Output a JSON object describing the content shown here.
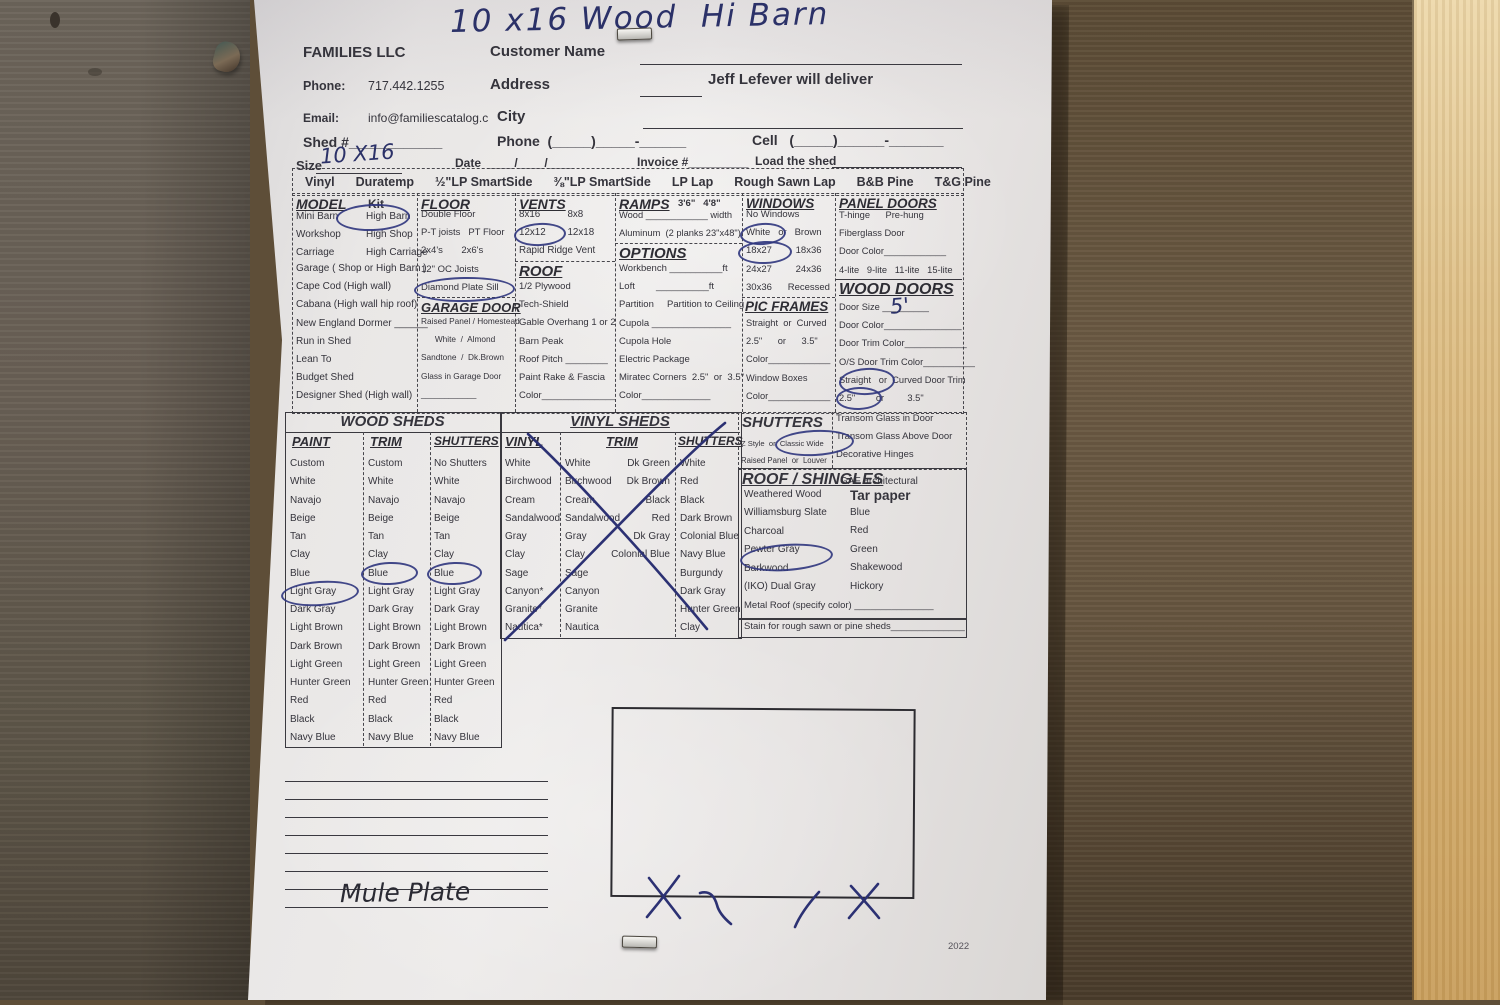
{
  "title_handwritten": "10 x16 Wood  Hi Barn",
  "header": {
    "company": "FAMILIES LLC",
    "customer_name_label": "Customer Name",
    "phone_label": "Phone:",
    "phone_value": "717.442.1255",
    "address_label": "Address",
    "deliver_note": "Jeff Lefever will deliver",
    "email_label": "Email:",
    "email_value": "info@familiescatalog.c",
    "city_label": "City",
    "shed_row": "Shed #____________",
    "phone_row": "Phone  (_____)_____-______",
    "cell_row": "Cell   (_____)______-_______",
    "size_label": "Size",
    "size_value_handwritten": "10 X16",
    "date_row": "Date  ____/____/____",
    "invoice_row": "Invoice #_________",
    "load_row": "Load the shed"
  },
  "siding_options": [
    "Vinyl",
    "Duratemp",
    "½\"LP SmartSide",
    "⅜\"LP SmartSide",
    "LP Lap",
    "Rough Sawn Lap",
    "B&B Pine",
    "T&G Pine"
  ],
  "model": {
    "header": "MODEL",
    "kit": "Kit",
    "pairs": [
      {
        "l": "Mini Barn",
        "r": "High Barn"
      },
      {
        "l": "Workshop",
        "r": "High Shop"
      },
      {
        "l": "Carriage",
        "r": "High Carriage"
      }
    ],
    "items": [
      "Garage ( Shop or High Barn )",
      "Cape Cod (High wall)",
      "Cabana (High wall hip roof)",
      "New England Dormer ______",
      "Run in Shed",
      "Lean To",
      "Budget Shed",
      "Designer Shed (High wall)"
    ]
  },
  "floor": {
    "header": "FLOOR",
    "items": [
      "Double Floor",
      "P-T joists   PT Floor",
      "2x4's       2x6's",
      "12\" OC Joists",
      "Diamond Plate Sill"
    ]
  },
  "garage_door": {
    "header": "GARAGE DOOR",
    "items": [
      "Raised Panel / Homestead",
      "      White  /  Almond",
      "Sandtone  /  Dk.Brown",
      "Glass in Garage Door",
      "____________"
    ]
  },
  "vents": {
    "header": "VENTS",
    "items": [
      "8x16          8x8",
      "12x12        12x18",
      "Rapid Ridge Vent"
    ]
  },
  "roof": {
    "header": "ROOF",
    "items": [
      "1/2 Plywood",
      "Tech-Shield",
      "Gable Overhang 1 or 2",
      "Barn Peak",
      "Roof Pitch ________",
      "Paint Rake & Fascia",
      "Color______________"
    ]
  },
  "ramps": {
    "header": "RAMPS",
    "sizes": "3'6\"   4'8\"",
    "items": [
      "Wood ____________ width",
      "Aluminum  (2 planks 23\"x48\")"
    ]
  },
  "options": {
    "header": "OPTIONS",
    "items": [
      "Workbench __________ft",
      "Loft        __________ft",
      "Partition     Partition to Ceiling",
      "Cupola _______________",
      "Cupola Hole",
      "Electric Package",
      "Miratec Corners  2.5\"  or  3.5\"",
      "Color_____________"
    ]
  },
  "windows": {
    "header": "WINDOWS",
    "items": [
      "No Windows",
      "White   or   Brown",
      "18x27         18x36",
      "24x27         24x36",
      "30x36      Recessed"
    ]
  },
  "pic_frames": {
    "header": "PIC FRAMES",
    "items": [
      "Straight  or  Curved",
      "2.5\"      or      3.5\"",
      "Color____________",
      "Window Boxes",
      "Color____________"
    ]
  },
  "panel_doors": {
    "header": "PANEL DOORS",
    "items": [
      "T-hinge      Pre-hung",
      "Fiberglass Door",
      "Door Color____________",
      "4-lite   9-lite   11-lite   15-lite"
    ]
  },
  "wood_doors": {
    "header": "WOOD DOORS",
    "size_value_handwritten": "5'",
    "items": [
      "Door Size _________",
      "Door Color_______________",
      "Door Trim Color____________",
      "O/S Door Trim Color__________",
      "Straight   or  Curved Door Trim",
      "2.5\"        or         3.5\""
    ]
  },
  "wood_sheds": {
    "title": "WOOD SHEDS",
    "col_headers": [
      "PAINT",
      "TRIM",
      "SHUTTERS"
    ],
    "paint": [
      "Custom",
      "White",
      "Navajo",
      "Beige",
      "Tan",
      "Clay",
      "Blue",
      "Light Gray",
      "Dark Gray",
      "Light Brown",
      "Dark Brown",
      "Light Green",
      "Hunter Green",
      "Red",
      "Black",
      "Navy Blue"
    ],
    "trim": [
      "Custom",
      "White",
      "Navajo",
      "Beige",
      "Tan",
      "Clay",
      "Blue",
      "Light Gray",
      "Dark Gray",
      "Light Brown",
      "Dark Brown",
      "Light Green",
      "Hunter Green",
      "Red",
      "Black",
      "Navy Blue"
    ],
    "shutters": [
      "No Shutters",
      "White",
      "Navajo",
      "Beige",
      "Tan",
      "Clay",
      "Blue",
      "Light Gray",
      "Dark Gray",
      "Light Brown",
      "Dark Brown",
      "Light Green",
      "Hunter Green",
      "Red",
      "Black",
      "Navy Blue"
    ]
  },
  "vinyl_sheds": {
    "title": "VINYL SHEDS",
    "col_headers": [
      "VINYL",
      "TRIM",
      "SHUTTERS"
    ],
    "vinyl": [
      "White",
      "Birchwood",
      "Cream",
      "Sandalwood",
      "Gray",
      "Clay",
      "Sage",
      "Canyon*",
      "Granite*",
      "Nautica*"
    ],
    "trim": [
      "White",
      "Birchwood",
      "Cream",
      "Sandalwood",
      "Gray",
      "Clay",
      "Sage",
      "Canyon",
      "Granite",
      "Nautica"
    ],
    "trim2": [
      "Dk Green",
      "Dk Brown",
      "Black",
      "Red",
      "Dk Gray",
      "Colonial Blue"
    ],
    "shutters": [
      "White",
      "Red",
      "Black",
      "Dark Brown",
      "Colonial Blue",
      "Navy Blue",
      "Burgundy",
      "Dark Gray",
      "Hunter Green",
      "Clay"
    ]
  },
  "shutters_box": {
    "header": "SHUTTERS",
    "row1": "Z Style  or  Classic Wide",
    "row2": "Raised Panel  or  Louver"
  },
  "transom_items": [
    "Transom Glass in Door",
    "Transom Glass Above Door",
    "Decorative Hinges"
  ],
  "roof_shingles": {
    "header": "ROOF / SHINGLES",
    "sub": "GAF architectural",
    "left": [
      "Weathered Wood",
      "Williamsburg Slate",
      "Charcoal",
      "Pewter Gray",
      "Barkwood",
      "(IKO) Dual Gray"
    ],
    "tar_paper": "Tar paper",
    "right": [
      "Blue",
      "Red",
      "Green",
      "Shakewood",
      "Hickory"
    ],
    "metal_row": "Metal Roof (specify color) _______________",
    "stain_row": "Stain for rough sawn or pine sheds______________"
  },
  "notes_handwritten": "Mule Plate",
  "footer_year": "2022",
  "ink_annotations": {
    "color": "#2c3173",
    "circled": [
      "High Barn",
      "Diamond Plate Sill",
      "12x12",
      "White (windows)",
      "18x27",
      "Straight (door trim)",
      "2.5\" (door trim)",
      "Light Gray (paint)",
      "Blue (trim)",
      "Blue (shutters)",
      "Classic Wide",
      "Pewter Gray"
    ],
    "crossed_out": "Vinyl Sheds section"
  }
}
